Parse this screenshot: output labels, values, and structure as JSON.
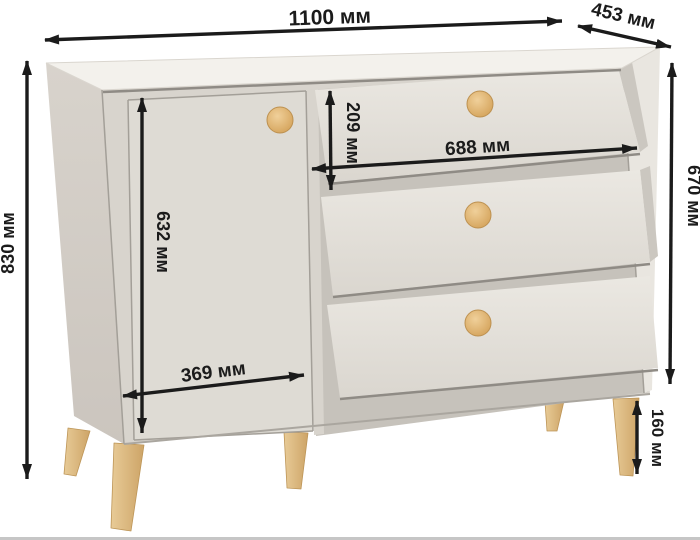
{
  "dimensions": {
    "overall_width": "1100 мм",
    "depth": "453 мм",
    "overall_height": "830 мм",
    "body_height": "670 мм",
    "top_drawer_height": "209 мм",
    "drawer_width": "688 мм",
    "door_height": "632 мм",
    "door_width": "369 мм",
    "leg_height": "160 мм"
  },
  "scene": {
    "subject": "chest of drawers with one door and three drawers",
    "drawer_count": 3,
    "knob_count": 4,
    "visible_leg_count": 5
  },
  "colors": {
    "annotation": "#1b1b1b",
    "cabinet_top": "#f3f1ec",
    "cabinet_front": "#dcd8d1",
    "cabinet_side": "#d2cdc6",
    "recess": "#c6c2bb",
    "wood_knob": "#d9a95e",
    "wood_leg": "#ddb87e",
    "background": "#ffffff"
  }
}
